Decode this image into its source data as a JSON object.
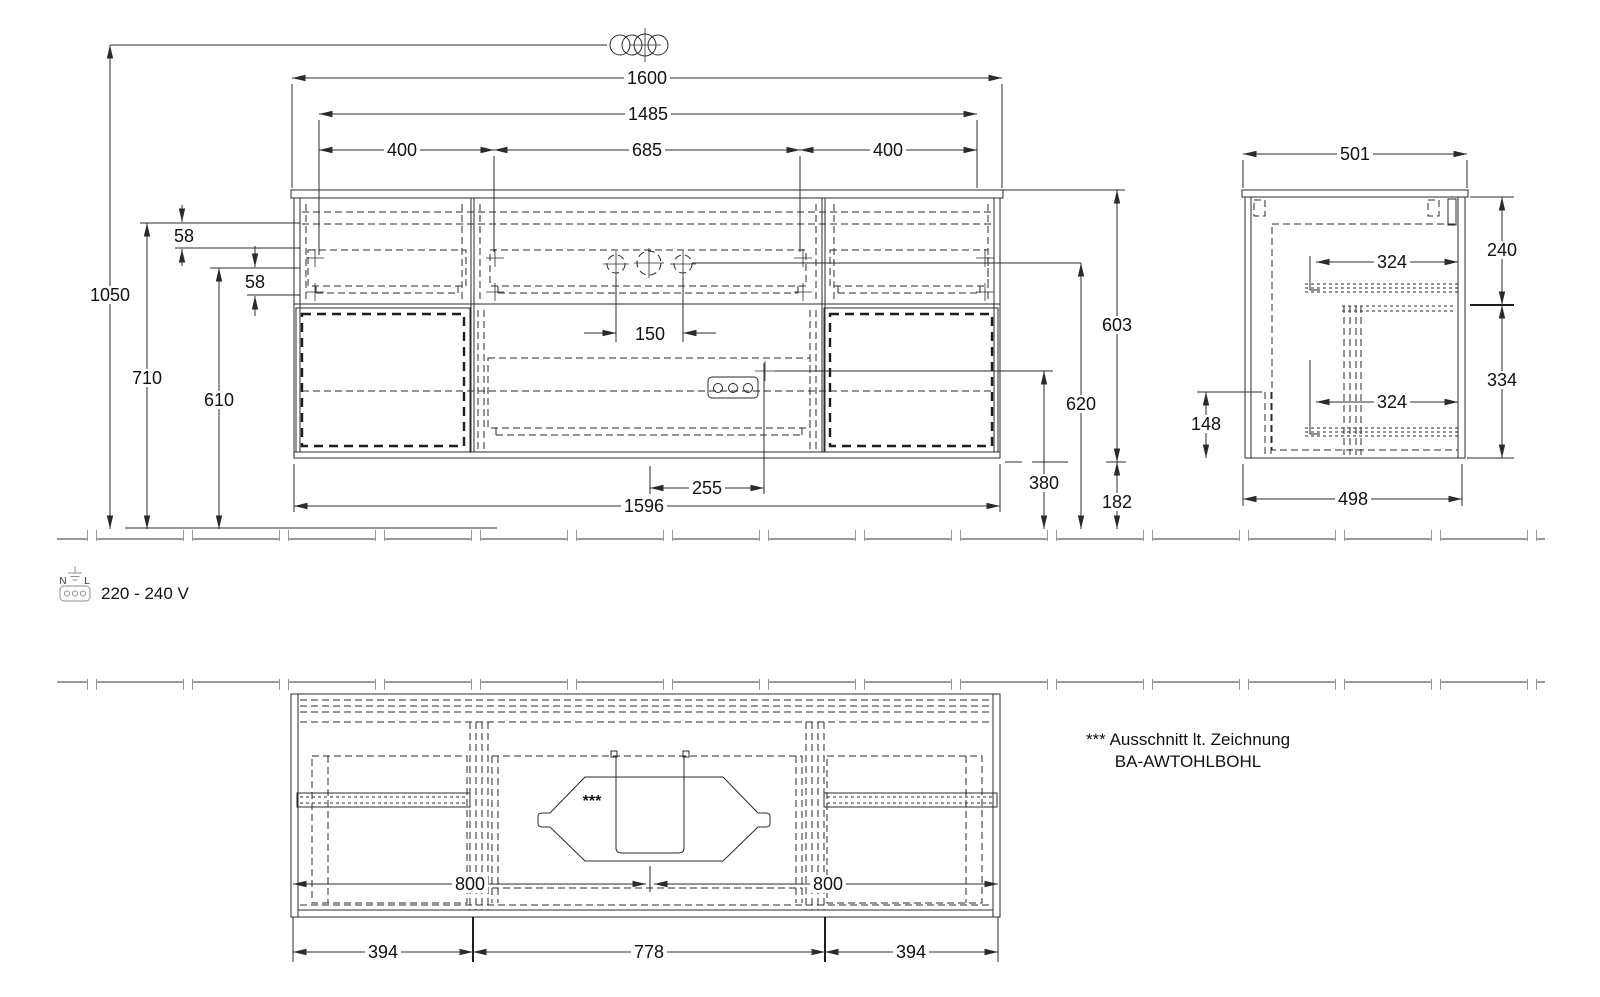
{
  "front": {
    "w1600": "1600",
    "w1485": "1485",
    "w400l": "400",
    "w685": "685",
    "w400r": "400",
    "h1050": "1050",
    "h710": "710",
    "h610": "610",
    "g58a": "58",
    "g58b": "58",
    "tap150": "150",
    "off255": "255",
    "w1596": "1596",
    "h603": "603",
    "h620": "620",
    "h380": "380",
    "h182": "182"
  },
  "side": {
    "w501": "501",
    "h240": "240",
    "i324a": "324",
    "i324b": "324",
    "h334": "334",
    "h148": "148",
    "w498": "498"
  },
  "plan": {
    "l800": "800",
    "r800": "800",
    "b394l": "394",
    "b778": "778",
    "b394r": "394",
    "stars": "***"
  },
  "legend": {
    "voltage": "220 - 240 V",
    "n": "N",
    "l": "L"
  },
  "note": {
    "line1": "*** Ausschnitt lt. Zeichnung",
    "line2": "BA-AWTOHLBOHL"
  }
}
